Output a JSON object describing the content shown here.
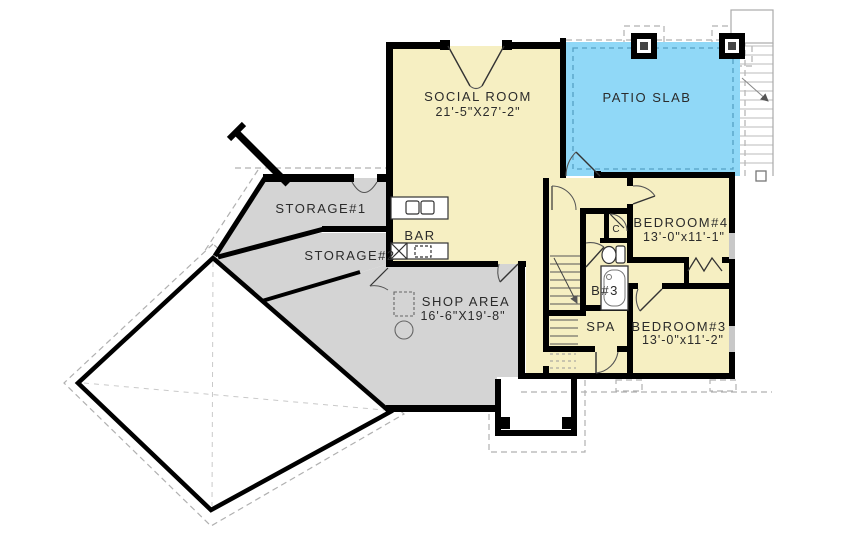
{
  "rooms": {
    "social": {
      "label": "SOCIAL ROOM",
      "dims": "21'-5\"X27'-2\""
    },
    "patio": {
      "label": "PATIO SLAB"
    },
    "storage1": {
      "label": "STORAGE#1"
    },
    "storage2": {
      "label": "STORAGE#2"
    },
    "bar": {
      "label": "BAR"
    },
    "shop": {
      "label": "SHOP AREA",
      "dims": "16'-6\"X19'-8\""
    },
    "bedroom4": {
      "label": "BEDROOM#4",
      "dims": "13'-0\"x11'-1\""
    },
    "bedroom3": {
      "label": "BEDROOM#3",
      "dims": "13'-0\"x11'-2\""
    },
    "bath3": {
      "label": "B#3"
    },
    "spa": {
      "label": "SPA"
    },
    "closet": {
      "label": "C"
    }
  },
  "colors": {
    "room": "#f6efc2",
    "patio": "#90d8f7",
    "utility": "#d4d4d4",
    "wall": "#000000",
    "footing": "#b0b0b0",
    "white": "#ffffff"
  }
}
